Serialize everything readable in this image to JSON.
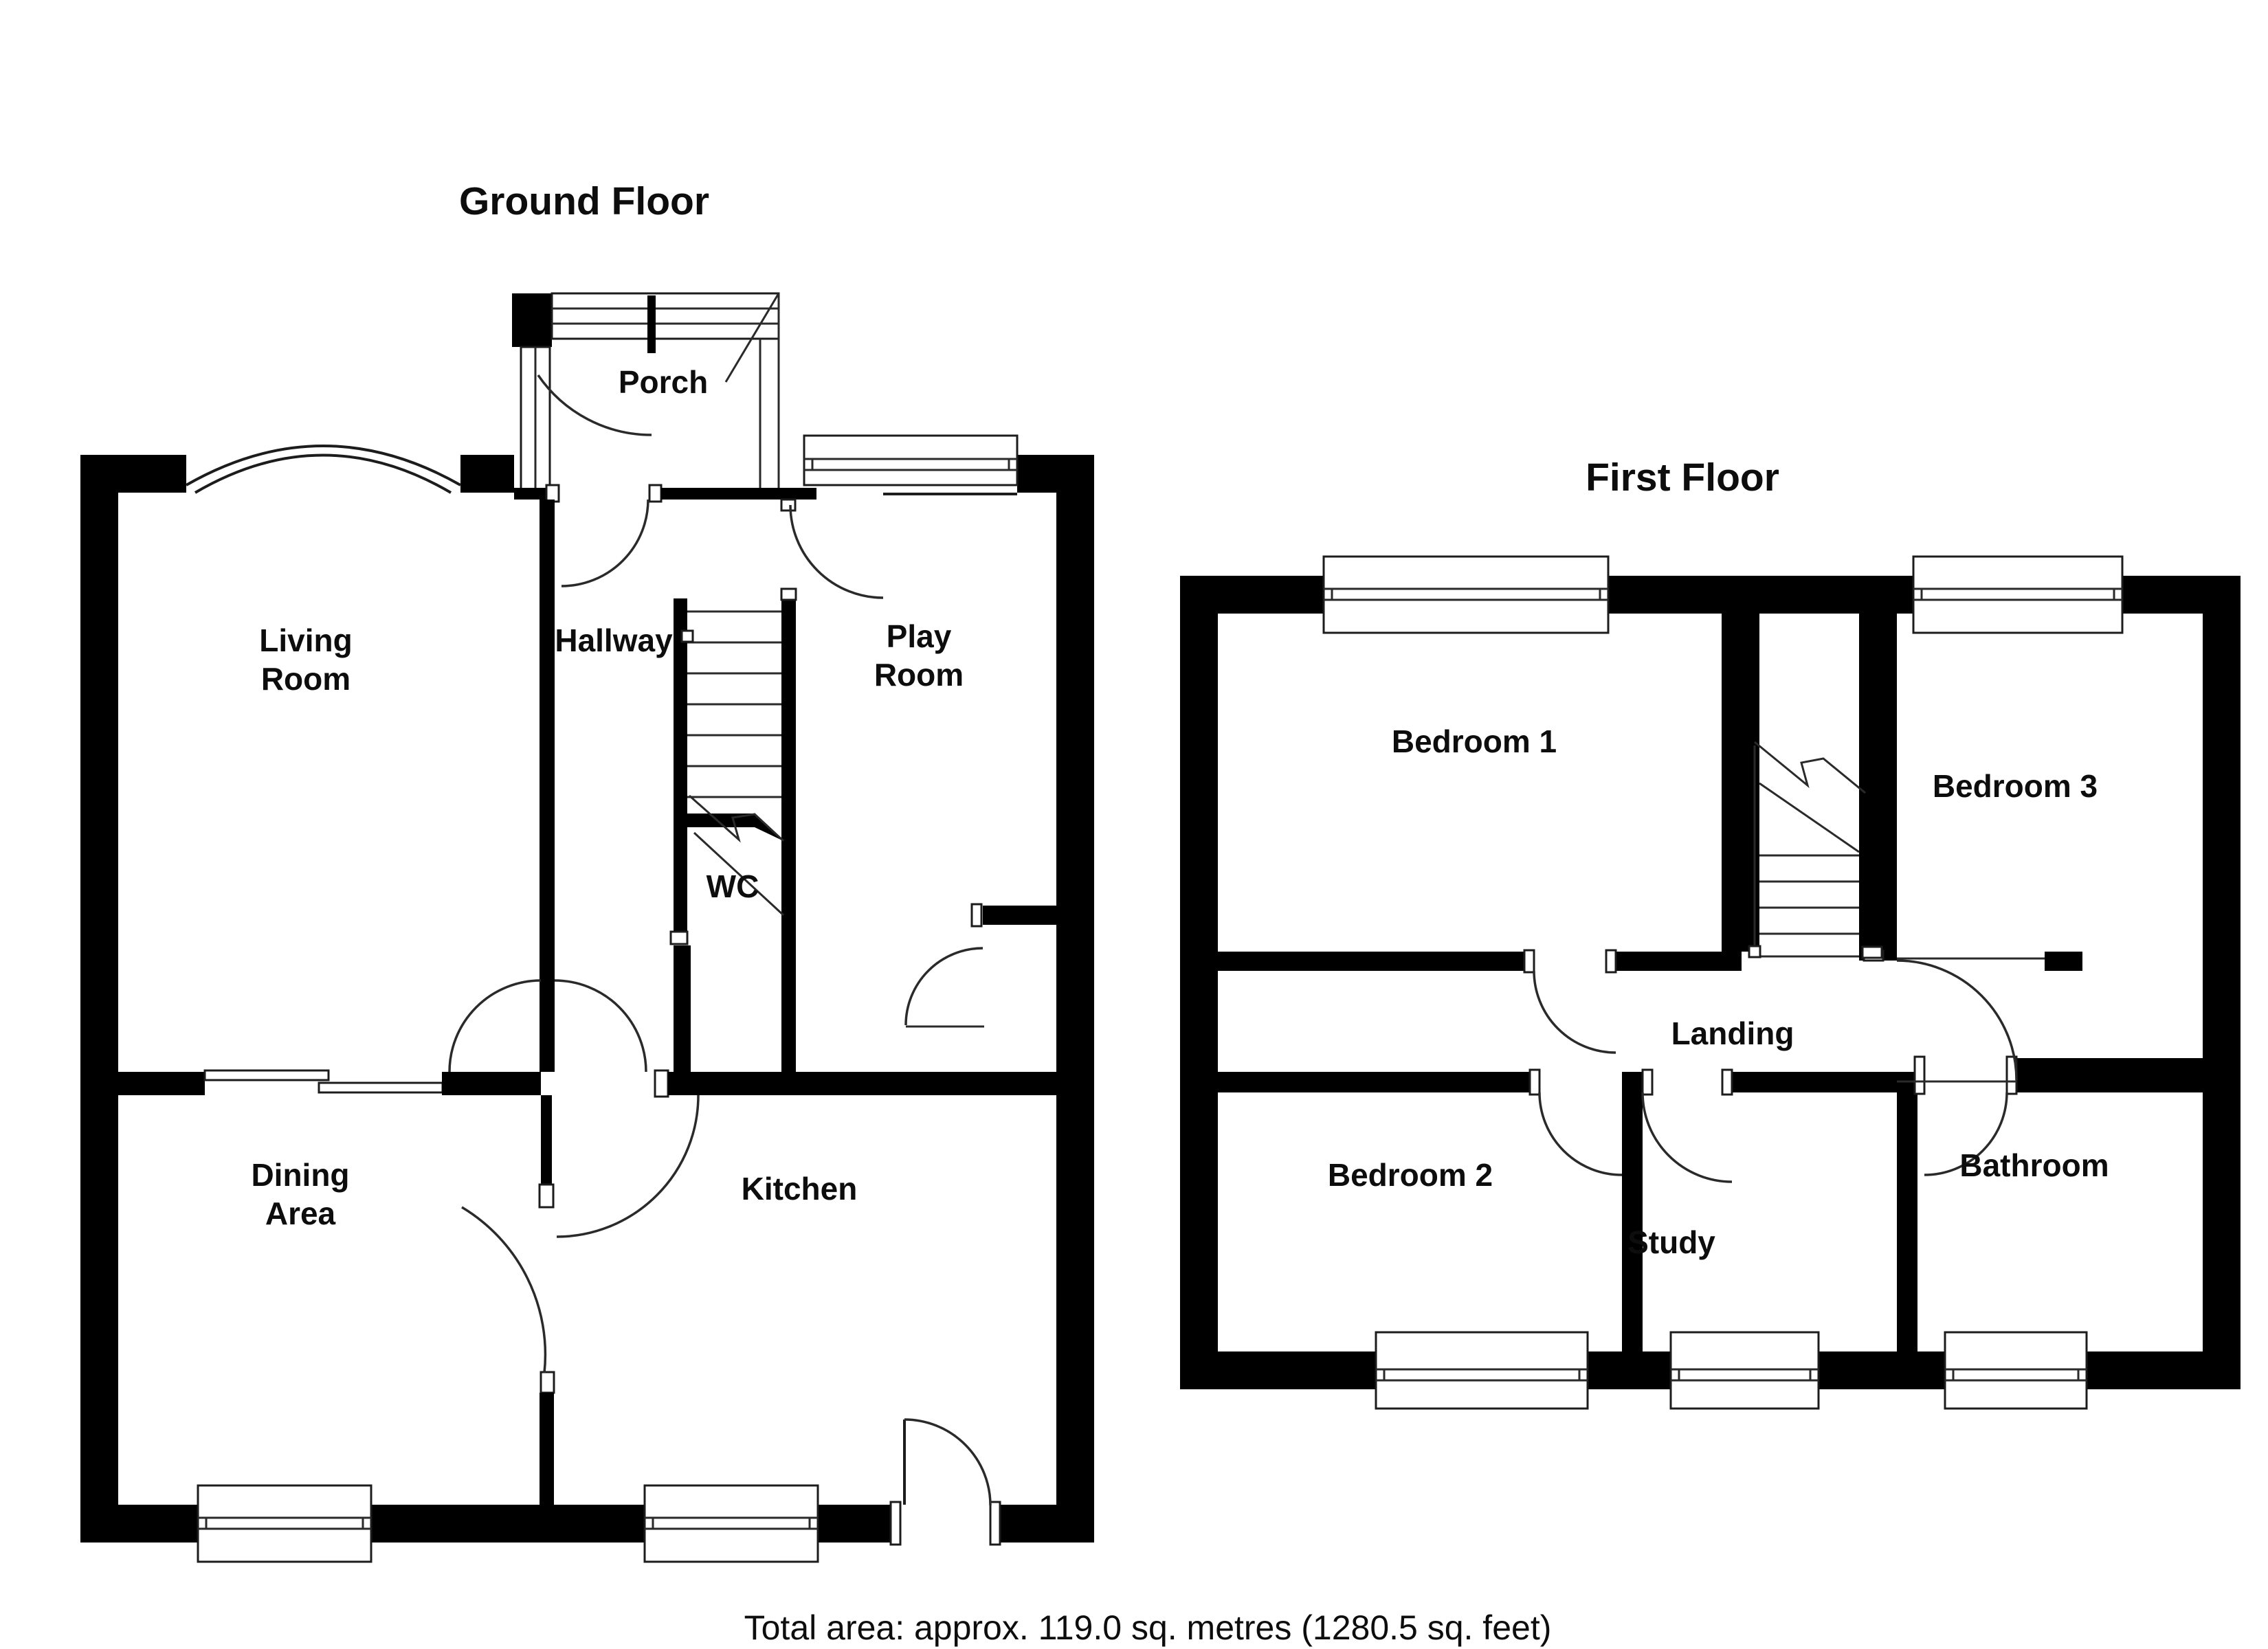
{
  "document": {
    "type": "floor-plan",
    "background_color": "#ffffff",
    "wall_color": "#000000",
    "text_color": "#0d0d0d"
  },
  "ground_floor": {
    "title": "Ground Floor",
    "rooms": {
      "porch": "Porch",
      "living_room_line1": "Living",
      "living_room_line2": "Room",
      "hallway": "Hallway",
      "play_room_line1": "Play",
      "play_room_line2": "Room",
      "wc": "WC",
      "dining_area_line1": "Dining",
      "dining_area_line2": "Area",
      "kitchen": "Kitchen"
    }
  },
  "first_floor": {
    "title": "First Floor",
    "rooms": {
      "bedroom_1": "Bedroom 1",
      "bedroom_3": "Bedroom 3",
      "bedroom_2": "Bedroom 2",
      "landing": "Landing",
      "study": "Study",
      "bathroom": "Bathroom"
    }
  },
  "footer": {
    "total_area": "Total area: approx. 119.0 sq. metres (1280.5 sq. feet)"
  }
}
